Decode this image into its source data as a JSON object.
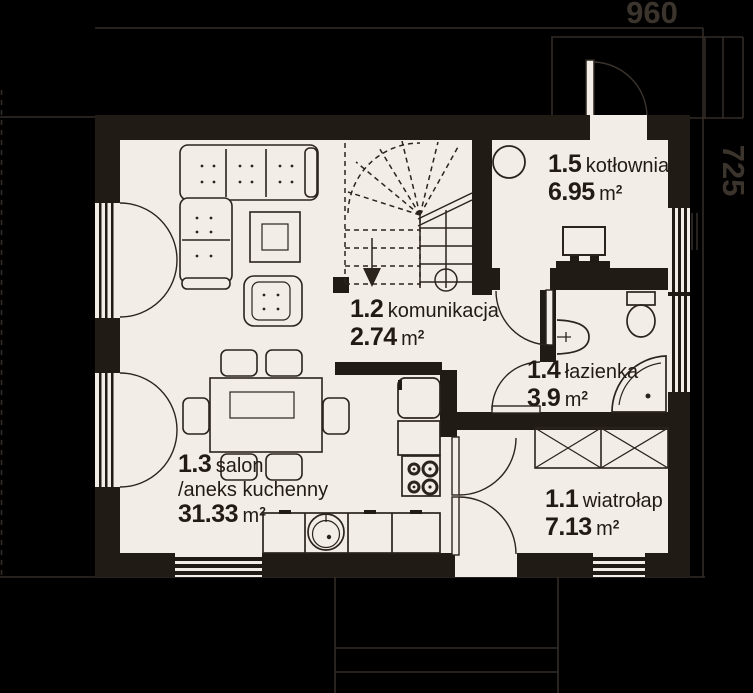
{
  "drawing": {
    "type": "floor-plan",
    "dimensions": {
      "width_label": "960",
      "height_label": "725"
    },
    "rooms": {
      "wiatrolap": {
        "number": "1.1",
        "name": "wiatrołap",
        "area": "7.13",
        "unit": "m",
        "sup": "2"
      },
      "komunikacja": {
        "number": "1.2",
        "name": "komunikacja",
        "area": "2.74",
        "unit": "m",
        "sup": "2"
      },
      "salon": {
        "number": "1.3",
        "name": "salon",
        "name_line2": "/aneks kuchenny",
        "area": "31.33",
        "unit": "m",
        "sup": "2"
      },
      "lazienka": {
        "number": "1.4",
        "name": "łazienka",
        "area": "3.9",
        "unit": "m",
        "sup": "2"
      },
      "kotlownia": {
        "number": "1.5",
        "name": "kotłownia",
        "area": "6.95",
        "unit": "m",
        "sup": "2"
      }
    },
    "colors": {
      "background": "#000000",
      "wall": "#211b15",
      "floor": "#f2eee7",
      "ink": "#2b241c",
      "dimension": "#3b342d"
    },
    "furniture": [
      "corner-sofa",
      "armchair",
      "coffee-table",
      "dining-table",
      "dining-chairs",
      "kitchen-counter",
      "kitchen-sink",
      "stove",
      "fridge",
      "wardrobe",
      "stairs",
      "boiler",
      "water-heater",
      "toilet",
      "washbasin",
      "shower"
    ]
  }
}
